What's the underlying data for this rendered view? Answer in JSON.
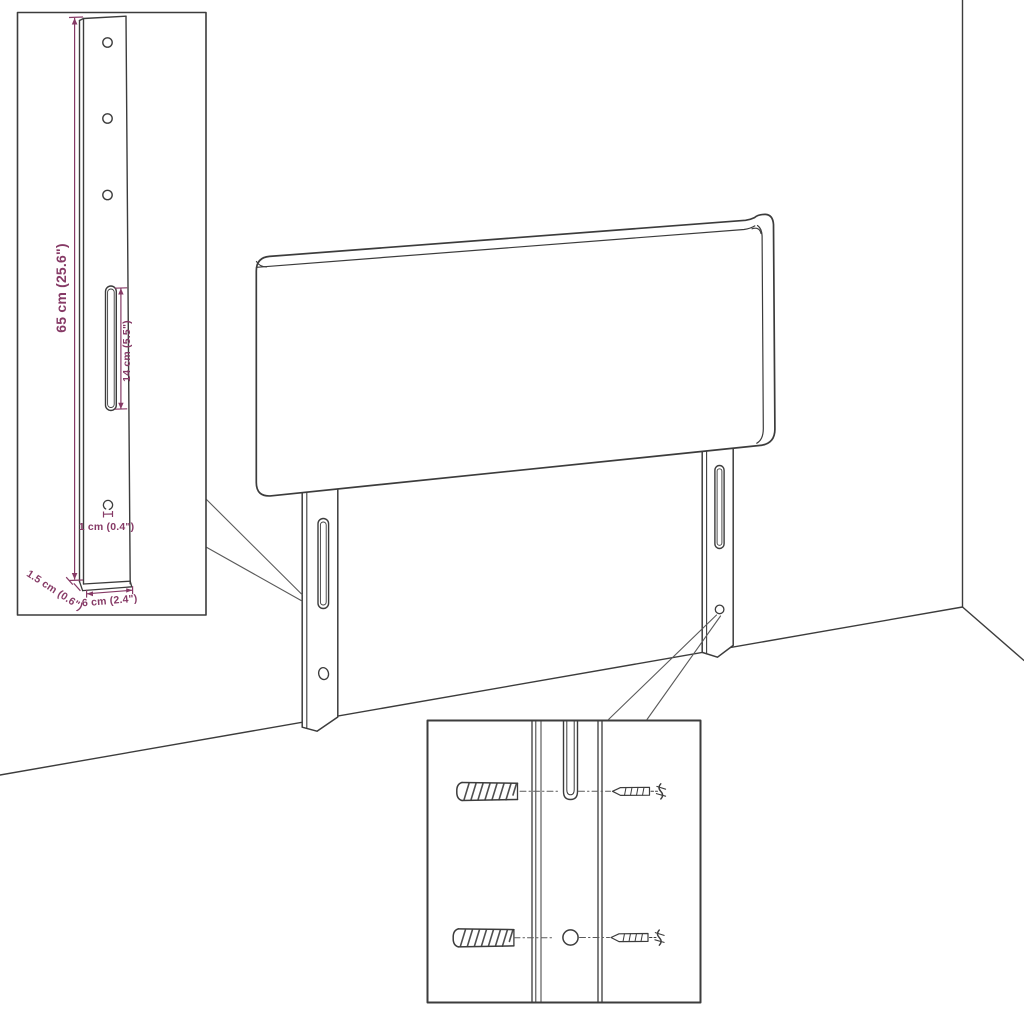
{
  "colors": {
    "background": "#ffffff",
    "line": "#3c3c3c",
    "line_soft": "#5a5a5a",
    "dimension": "#863a66"
  },
  "labels": {
    "bracket_height": "65 cm (25.6\")",
    "slot_length": "14 cm (5.5\")",
    "hole_diameter": "1 cm (0.4\")",
    "bracket_depth": "1.5 cm (0.6\")",
    "bracket_width": "6 cm (2.4\")"
  }
}
